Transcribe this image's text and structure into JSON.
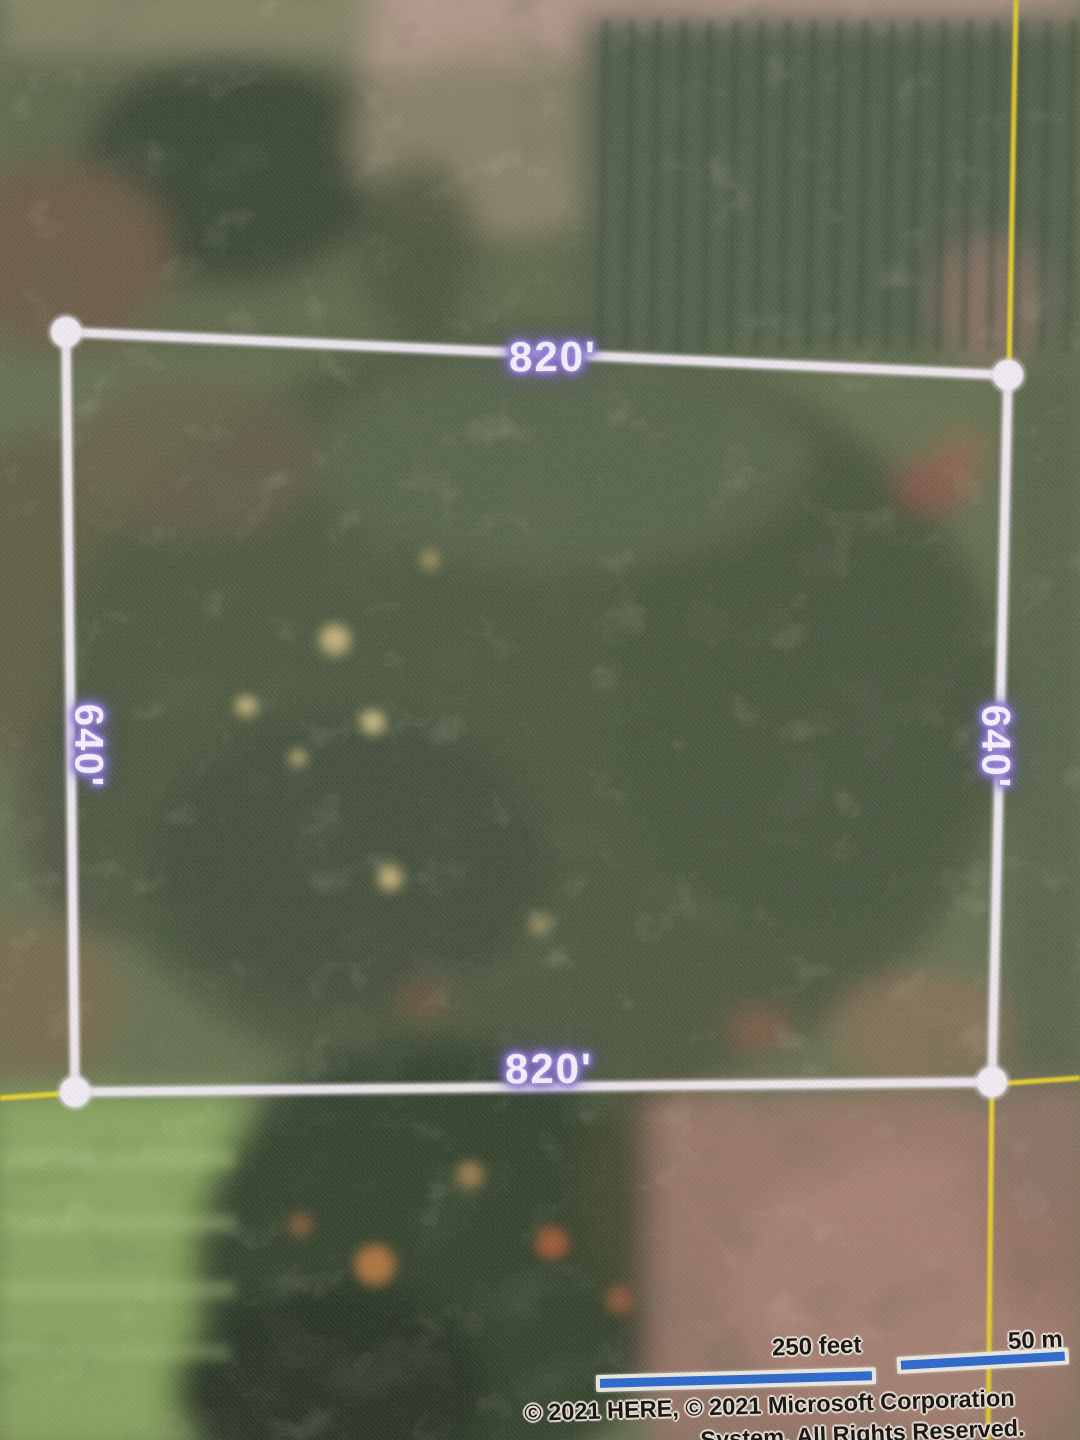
{
  "parcel": {
    "top_dimension": "820'",
    "bottom_dimension": "820'",
    "left_dimension": "640'",
    "right_dimension": "640'"
  },
  "scale_bar": {
    "feet": "250 feet",
    "meters": "50 m"
  },
  "attribution": {
    "line1": "© 2021 HERE, © 2021 Microsoft Corporation",
    "line2": "System, All Rights Reserved."
  },
  "colors": {
    "boundary_line": "#efe8f0",
    "dimension_text": "#f5effc",
    "dimension_glow": "#8573cc",
    "section_line_yellow": "#ecd52f",
    "scale_bar_blue": "#2e6cd4",
    "scale_bar_border": "#f2efe6",
    "attribution_text": "#17130e",
    "attribution_halo": "#efe9e2"
  }
}
